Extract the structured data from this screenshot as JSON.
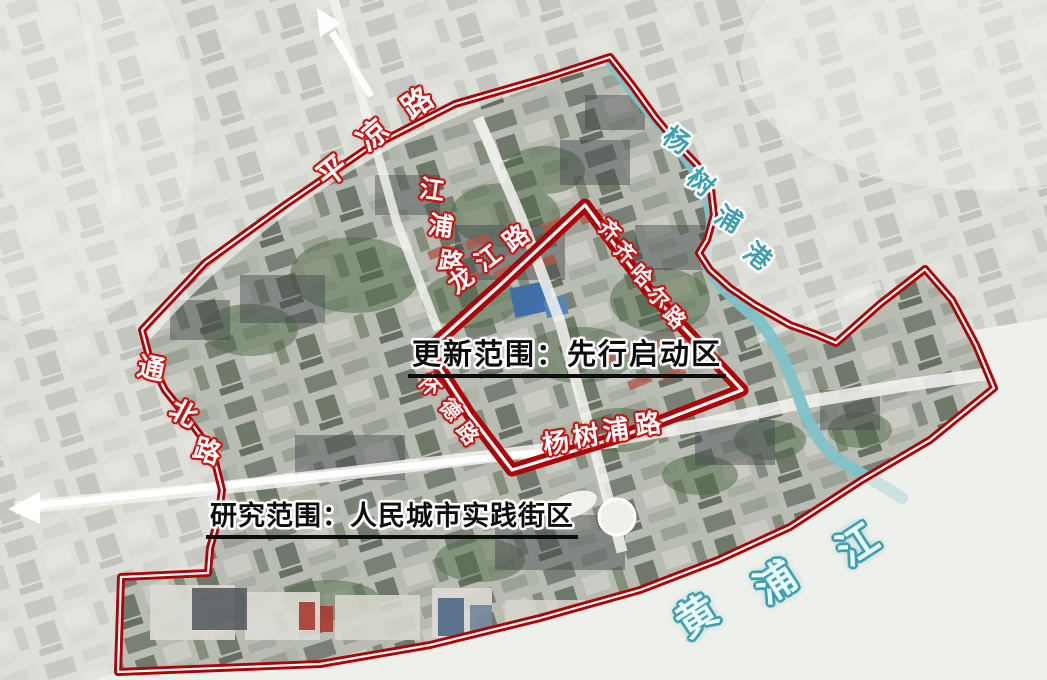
{
  "map": {
    "region_titles": {
      "update_scope": "更新范围：先行启动区",
      "research_scope": "研究范围：人民城市实践街区"
    },
    "road_labels": {
      "pingliang": "平凉路",
      "jiangpu": "江浦路",
      "longjiang": "龙江路",
      "qiqihar": "齐齐哈尔路",
      "huaide": "怀德路",
      "tongbei": "通北路",
      "yangshupu_road": "杨树浦路"
    },
    "water_labels": {
      "yangshupu_port": "杨树浦港",
      "huangpu_river": "黄浦江"
    }
  },
  "colors": {
    "boundary_red": "#ab0509",
    "road_label_red": "#c41414",
    "water_teal": "#3f9fae",
    "water_fill": "#7fc2c8",
    "title_black": "#0d0d0d"
  }
}
